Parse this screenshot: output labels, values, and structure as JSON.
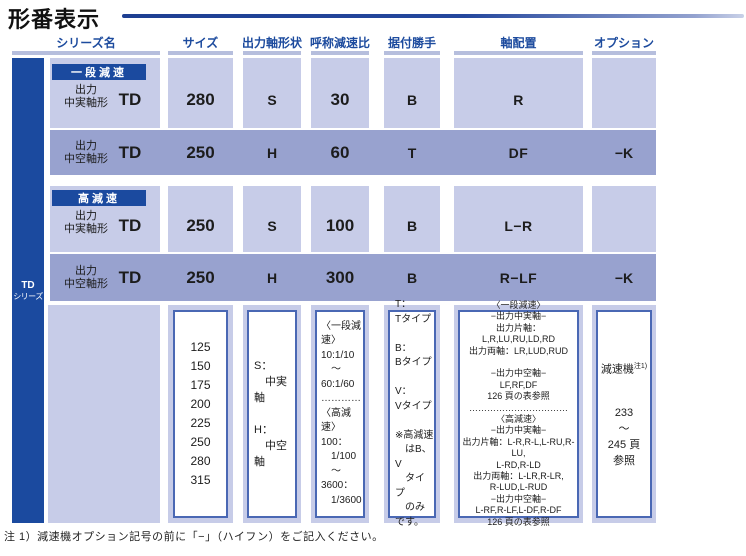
{
  "page": {
    "title": "形番表示",
    "footnote": "注 1）減速機オプション記号の前に「−」（ハイフン）をご記入ください。"
  },
  "colors": {
    "accent_blue": "#1b4a9f",
    "row_light": "#c7cce8",
    "row_dark": "#98a2cf",
    "header_text": "#1d4b9e",
    "box_border": "#4a68b4"
  },
  "columns": {
    "series": "シリーズ名",
    "size": "サイズ",
    "shape": "出力軸形状",
    "ratio": "呼称減速比",
    "mount": "据付勝手",
    "arrangement": "軸配置",
    "option": "オプション"
  },
  "sidebar": {
    "line1": "TD",
    "line2": "シリーズ"
  },
  "rows": [
    {
      "badge": "一段減速",
      "label": [
        "出力",
        "中実軸形"
      ],
      "series": "TD",
      "size": "280",
      "shape": "S",
      "ratio": "30",
      "mount": "B",
      "arrangement": "R",
      "option": ""
    },
    {
      "badge": "",
      "label": [
        "出力",
        "中空軸形"
      ],
      "series": "TD",
      "size": "250",
      "shape": "H",
      "ratio": "60",
      "mount": "T",
      "arrangement": "DF",
      "option": "−K"
    },
    {
      "badge": "高減速",
      "label": [
        "出力",
        "中実軸形"
      ],
      "series": "TD",
      "size": "250",
      "shape": "S",
      "ratio": "100",
      "mount": "B",
      "arrangement": "L−R",
      "option": ""
    },
    {
      "badge": "",
      "label": [
        "出力",
        "中空軸形"
      ],
      "series": "TD",
      "size": "250",
      "shape": "H",
      "ratio": "300",
      "mount": "B",
      "arrangement": "R−LF",
      "option": "−K"
    }
  ],
  "legend": {
    "size_list": [
      "125",
      "150",
      "175",
      "200",
      "225",
      "250",
      "280",
      "315"
    ],
    "shape_box": [
      "S：",
      "　中実軸",
      "",
      "H：",
      "　中空軸"
    ],
    "ratio_box": [
      "〈一段減速〉",
      "10:1/10",
      "　〜",
      "60:1/60",
      "…………",
      "〈高減速〉",
      "100：",
      "　1/100",
      "　〜",
      "3600：",
      "　1/3600"
    ],
    "mount_box": [
      "T：",
      "Tタイプ",
      "",
      "B：",
      "Bタイプ",
      "",
      "V：",
      "Vタイプ",
      "",
      "※高減速",
      "　はB、V",
      "　タイプ",
      "　のみです。"
    ],
    "arrangement_box": [
      "〈一段減速〉",
      "−出力中実軸−",
      "出力片軸：L,R,LU,RU,LD,RD",
      "出力両軸：LR,LUD,RUD",
      "",
      "−出力中空軸−",
      "LF,RF,DF",
      "126 頁の表参照",
      "……………………………",
      "〈高減速〉",
      "−出力中実軸−",
      "出力片軸：L-R,R-L,L-RU,R-LU,",
      "L-RD,R-LD",
      "出力両軸：L-LR,R-LR,",
      "R-LUD,L-RUD",
      "−出力中空軸−",
      "L-RF,R-LF,L-DF,R-DF",
      "126 頁の表参照"
    ],
    "option_box": {
      "name": "減速機",
      "sup": "注1)",
      "lines": [
        "233",
        "〜",
        "245 頁",
        "参照"
      ]
    }
  }
}
